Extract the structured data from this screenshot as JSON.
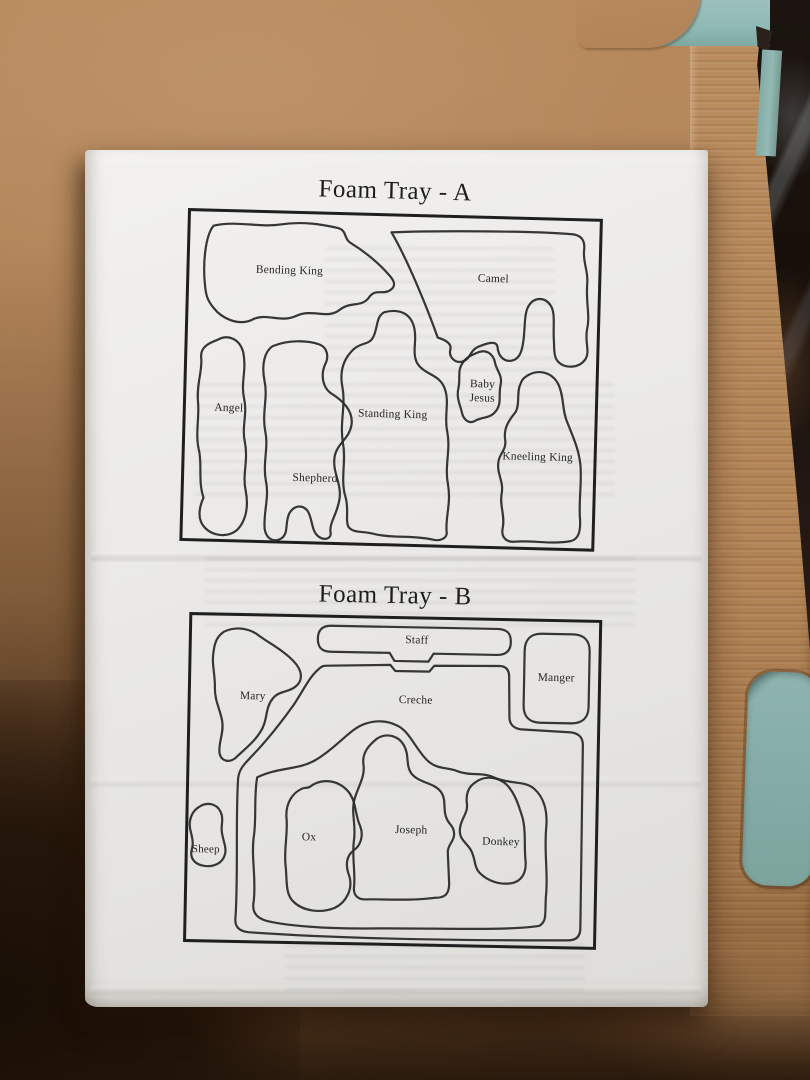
{
  "tray_a": {
    "title": "Foam Tray - A",
    "labels": {
      "bending_king": "Bending King",
      "camel": "Camel",
      "angel": "Angel",
      "shepherd": "Shepherd",
      "standing_king": "Standing King",
      "baby_jesus": "Baby Jesus",
      "kneeling_king": "Kneeling King"
    }
  },
  "tray_b": {
    "title": "Foam Tray - B",
    "labels": {
      "staff": "Staff",
      "manger": "Manger",
      "mary": "Mary",
      "creche": "Creche",
      "sheep": "Sheep",
      "ox": "Ox",
      "joseph": "Joseph",
      "donkey": "Donkey"
    }
  },
  "colors": {
    "cardboard": "#b1845a",
    "paper": "#ebeae8",
    "outline": "#2b2b2b",
    "foam_teal": "#8fb9b4",
    "shadow_dark": "#1d1107"
  }
}
